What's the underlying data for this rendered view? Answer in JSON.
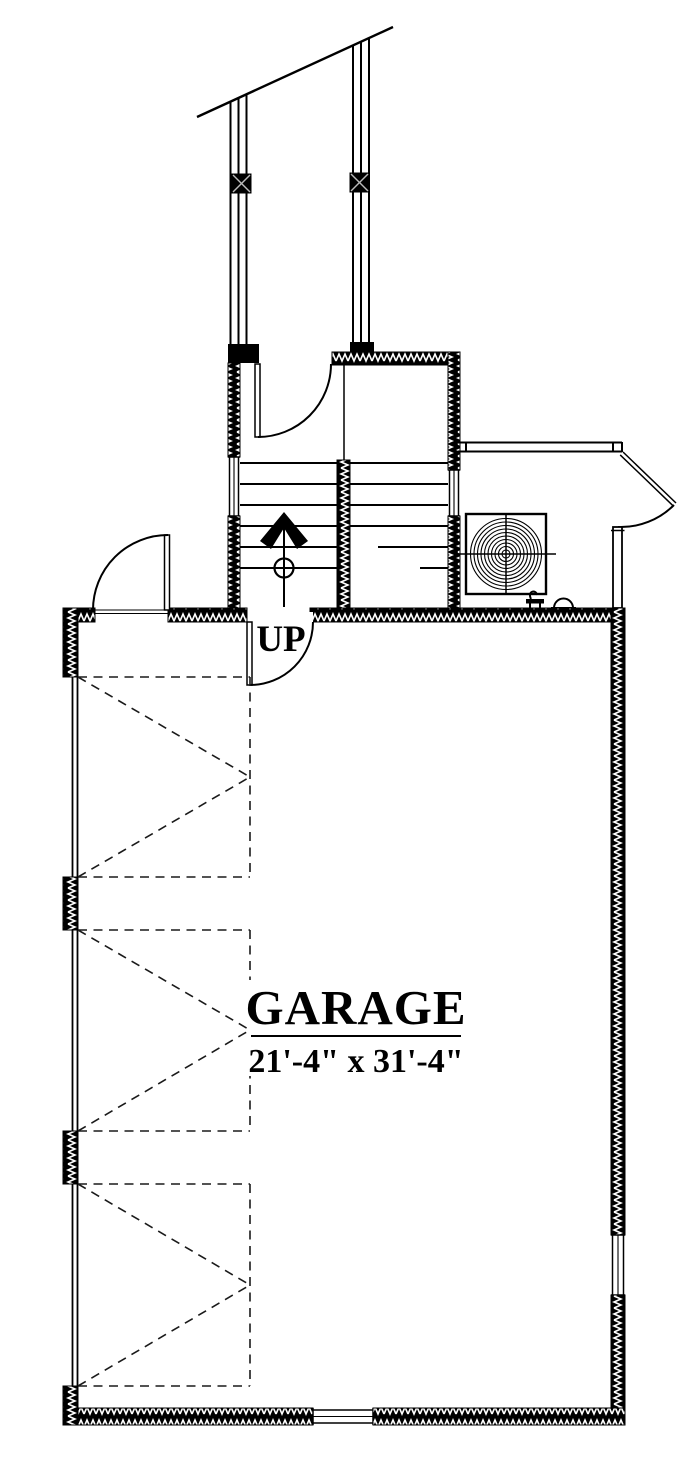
{
  "plan": {
    "room": {
      "name": "GARAGE",
      "dimensions": "21'-4\" x 31'-4\""
    },
    "stairs": {
      "direction_label": "UP"
    }
  },
  "icons": {
    "water_heater": "concentric-coil-in-square",
    "hose_bib": "faucet-valve",
    "pipe_cap": "semicircle-dome",
    "stair_arrow": "up-chevron-arrow",
    "wall_hatch": "insulation-zigzag",
    "garage_door_bay": "dashed-v-overhead-door",
    "door_swing": "quarter-arc"
  },
  "colors": {
    "line": "#000000",
    "background": "#ffffff",
    "dashed_lines": "#1a1a1a",
    "wall_fill": "#000000",
    "hatch_marks": "#ffffff"
  }
}
